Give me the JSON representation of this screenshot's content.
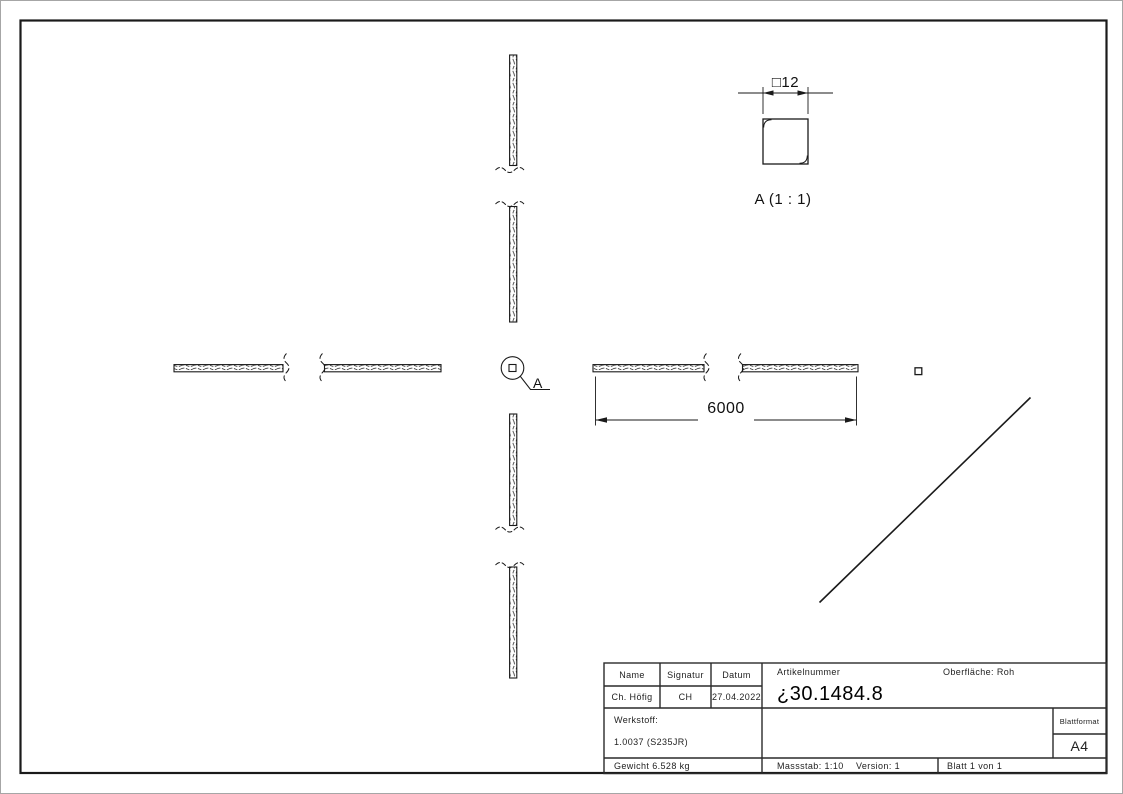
{
  "colors": {
    "line": "#1a1a1a",
    "background": "#ffffff",
    "texture": "#3a3a3a"
  },
  "drawing": {
    "length_dimension": "6000",
    "detail_callout_label": "A",
    "detail_view": {
      "dimension": "□12",
      "label": "A (1 : 1)"
    }
  },
  "title_block": {
    "headers": {
      "name": "Name",
      "signatur": "Signatur",
      "datum": "Datum"
    },
    "values": {
      "name": "Ch. Höfig",
      "signatur": "CH",
      "datum": "27.04.2022"
    },
    "artikelnummer_label": "Artikelnummer",
    "artikelnummer": "¿30.1484.8",
    "oberflaeche": "Oberfläche:  Roh",
    "werkstoff_label": "Werkstoff:",
    "werkstoff": "1.0037 (S235JR)",
    "gewicht": "Gewicht 6.528 kg",
    "massstab": "Massstab: 1:10",
    "version": "Version: 1",
    "blatt": "Blatt 1 von 1",
    "blattformat_label": "Blattformat",
    "blattformat": "A4"
  }
}
